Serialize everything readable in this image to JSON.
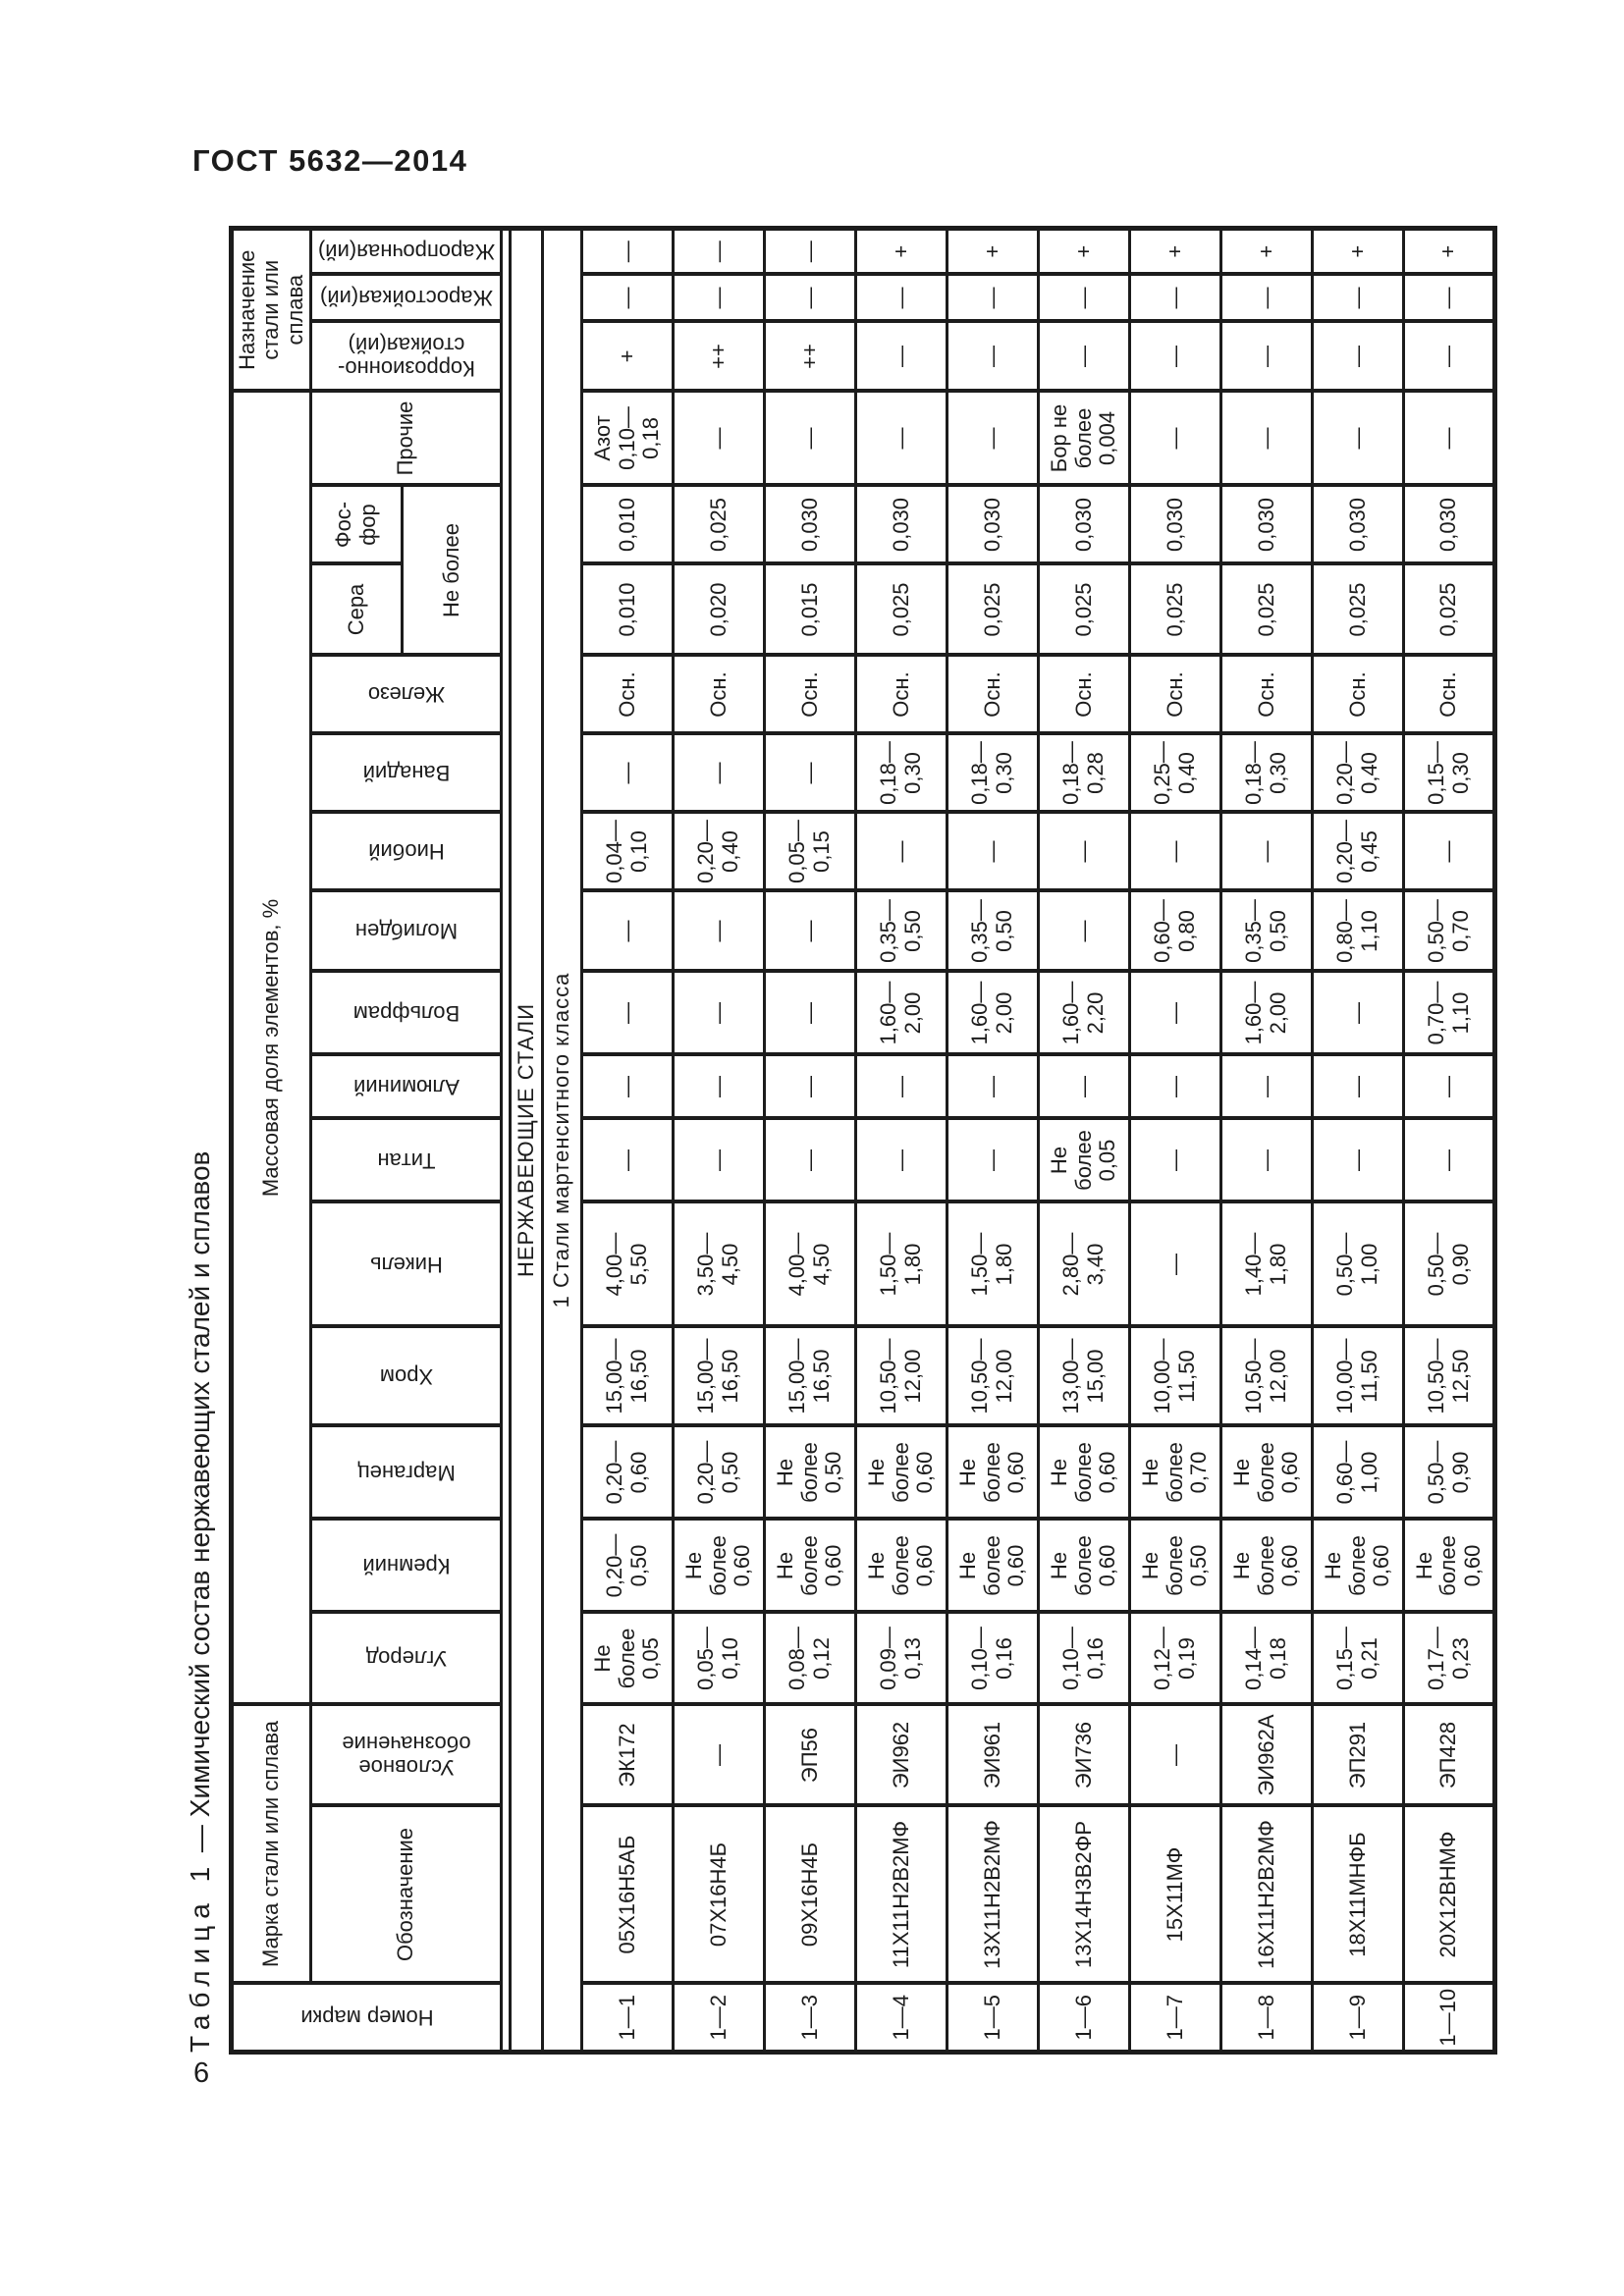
{
  "page": {
    "standard": "ГОСТ 5632—2014",
    "page_number": "6"
  },
  "caption": {
    "label": "Таблица 1",
    "rest": " — Химический состав нержавеющих сталей и сплавов"
  },
  "table": {
    "header": {
      "number": "Номер марки",
      "mark_group": "Марка стали или сплава",
      "designation": "Обозначение",
      "conventional": "Условное\nобозначение",
      "mass_fraction": "Массовая доля элементов, %",
      "elements": {
        "c": "Углерод",
        "si": "Кремний",
        "mn": "Марганец",
        "cr": "Хром",
        "ni": "Никель",
        "ti": "Титан",
        "al": "Алюминий",
        "w": "Вольфрам",
        "mo": "Молибден",
        "nb": "Ниобий",
        "v": "Ванадий",
        "fe": "Железо",
        "s": "Сера",
        "p": "Фос-\nфор",
        "other": "Прочие"
      },
      "not_more": "Не более",
      "purpose_group": "Назначение\nстали или\nсплава",
      "purpose": [
        "Коррозионно-\nстойкая(ий)",
        "Жаростойкая(ий)",
        "Жаропрочная(ий)"
      ]
    },
    "sections": [
      "НЕРЖАВЕЮЩИЕ СТАЛИ",
      "1 Стали мартенситного класса"
    ],
    "rows": [
      {
        "num": "1—1",
        "mark": "05Х16Н5АБ",
        "conv": "ЭК172",
        "c": "Не\nболее\n0,05",
        "si": "0,20—\n0,50",
        "mn": "0,20—\n0,60",
        "cr": "15,00—\n16,50",
        "ni": "4,00—\n5,50",
        "ti": "—",
        "al": "—",
        "w": "—",
        "mo": "—",
        "nb": "0,04—\n0,10",
        "v": "—",
        "fe": "Осн.",
        "s": "0,010",
        "p": "0,010",
        "other": "Азот\n0,10—\n0,18",
        "corr": "+",
        "heat": "—",
        "strength": "—"
      },
      {
        "num": "1—2",
        "mark": "07Х16Н4Б",
        "conv": "—",
        "c": "0,05—\n0,10",
        "si": "Не\nболее\n0,60",
        "mn": "0,20—\n0,50",
        "cr": "15,00—\n16,50",
        "ni": "3,50—\n4,50",
        "ti": "—",
        "al": "—",
        "w": "—",
        "mo": "—",
        "nb": "0,20—\n0,40",
        "v": "—",
        "fe": "Осн.",
        "s": "0,020",
        "p": "0,025",
        "other": "—",
        "corr": "++",
        "heat": "—",
        "strength": "—"
      },
      {
        "num": "1—3",
        "mark": "09Х16Н4Б",
        "conv": "ЭП56",
        "c": "0,08—\n0,12",
        "si": "Не\nболее\n0,60",
        "mn": "Не\nболее\n0,50",
        "cr": "15,00—\n16,50",
        "ni": "4,00—\n4,50",
        "ti": "—",
        "al": "—",
        "w": "—",
        "mo": "—",
        "nb": "0,05—\n0,15",
        "v": "—",
        "fe": "Осн.",
        "s": "0,015",
        "p": "0,030",
        "other": "—",
        "corr": "++",
        "heat": "—",
        "strength": "—"
      },
      {
        "num": "1—4",
        "mark": "11Х11Н2В2МФ",
        "conv": "ЭИ962",
        "c": "0,09—\n0,13",
        "si": "Не\nболее\n0,60",
        "mn": "Не\nболее\n0,60",
        "cr": "10,50—\n12,00",
        "ni": "1,50—\n1,80",
        "ti": "—",
        "al": "—",
        "w": "1,60—\n2,00",
        "mo": "0,35—\n0,50",
        "nb": "—",
        "v": "0,18—\n0,30",
        "fe": "Осн.",
        "s": "0,025",
        "p": "0,030",
        "other": "—",
        "corr": "—",
        "heat": "—",
        "strength": "+"
      },
      {
        "num": "1—5",
        "mark": "13Х11Н2В2МФ",
        "conv": "ЭИ961",
        "c": "0,10—\n0,16",
        "si": "Не\nболее\n0,60",
        "mn": "Не\nболее\n0,60",
        "cr": "10,50—\n12,00",
        "ni": "1,50—\n1,80",
        "ti": "—",
        "al": "—",
        "w": "1,60—\n2,00",
        "mo": "0,35—\n0,50",
        "nb": "—",
        "v": "0,18—\n0,30",
        "fe": "Осн.",
        "s": "0,025",
        "p": "0,030",
        "other": "—",
        "corr": "—",
        "heat": "—",
        "strength": "+"
      },
      {
        "num": "1—6",
        "mark": "13Х14Н3В2ФР",
        "conv": "ЭИ736",
        "c": "0,10—\n0,16",
        "si": "Не\nболее\n0,60",
        "mn": "Не\nболее\n0,60",
        "cr": "13,00—\n15,00",
        "ni": "2,80—\n3,40",
        "ti": "Не\nболее\n0,05",
        "al": "—",
        "w": "1,60—\n2,20",
        "mo": "—",
        "nb": "—",
        "v": "0,18—\n0,28",
        "fe": "Осн.",
        "s": "0,025",
        "p": "0,030",
        "other": "Бор не\nболее\n0,004",
        "corr": "—",
        "heat": "—",
        "strength": "+"
      },
      {
        "num": "1—7",
        "mark": "15Х11МФ",
        "conv": "—",
        "c": "0,12—\n0,19",
        "si": "Не\nболее\n0,50",
        "mn": "Не\nболее\n0,70",
        "cr": "10,00—\n11,50",
        "ni": "—",
        "ti": "—",
        "al": "—",
        "w": "—",
        "mo": "0,60—\n0,80",
        "nb": "—",
        "v": "0,25—\n0,40",
        "fe": "Осн.",
        "s": "0,025",
        "p": "0,030",
        "other": "—",
        "corr": "—",
        "heat": "—",
        "strength": "+"
      },
      {
        "num": "1—8",
        "mark": "16Х11Н2В2МФ",
        "conv": "ЭИ962А",
        "c": "0,14—\n0,18",
        "si": "Не\nболее\n0,60",
        "mn": "Не\nболее\n0,60",
        "cr": "10,50—\n12,00",
        "ni": "1,40—\n1,80",
        "ti": "—",
        "al": "—",
        "w": "1,60—\n2,00",
        "mo": "0,35—\n0,50",
        "nb": "—",
        "v": "0,18—\n0,30",
        "fe": "Осн.",
        "s": "0,025",
        "p": "0,030",
        "other": "—",
        "corr": "—",
        "heat": "—",
        "strength": "+"
      },
      {
        "num": "1—9",
        "mark": "18Х11МНФБ",
        "conv": "ЭП291",
        "c": "0,15—\n0,21",
        "si": "Не\nболее\n0,60",
        "mn": "0,60—\n1,00",
        "cr": "10,00—\n11,50",
        "ni": "0,50—\n1,00",
        "ti": "—",
        "al": "—",
        "w": "—",
        "mo": "0,80—\n1,10",
        "nb": "0,20—\n0,45",
        "v": "0,20—\n0,40",
        "fe": "Осн.",
        "s": "0,025",
        "p": "0,030",
        "other": "—",
        "corr": "—",
        "heat": "—",
        "strength": "+"
      },
      {
        "num": "1—10",
        "mark": "20Х12ВНМФ",
        "conv": "ЭП428",
        "c": "0,17—\n0,23",
        "si": "Не\nболее\n0,60",
        "mn": "0,50—\n0,90",
        "cr": "10,50—\n12,50",
        "ni": "0,50—\n0,90",
        "ti": "—",
        "al": "—",
        "w": "0,70—\n1,10",
        "mo": "0,50—\n0,70",
        "nb": "—",
        "v": "0,15—\n0,30",
        "fe": "Осн.",
        "s": "0,025",
        "p": "0,030",
        "other": "—",
        "corr": "—",
        "heat": "—",
        "strength": "+"
      }
    ]
  }
}
